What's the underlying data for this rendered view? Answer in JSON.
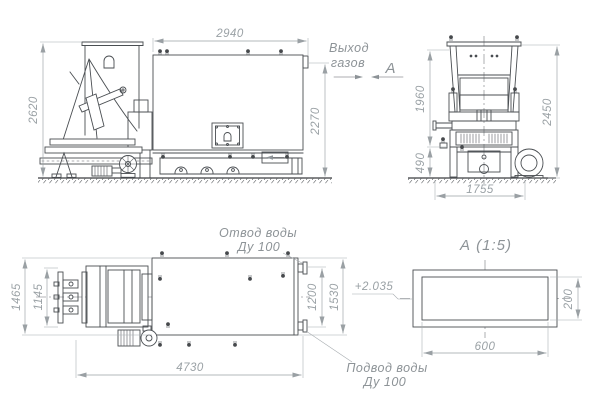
{
  "drawing": {
    "labels": {
      "gas_outlet_l1": "Выход",
      "gas_outlet_l2": "газов",
      "view_letter": "А",
      "water_outlet_l1": "Отвод воды",
      "water_outlet_l2": "Ду 100",
      "water_inlet_l1": "Подвод воды",
      "water_inlet_l2": "Ду 100",
      "section_title": "А  (1:5)",
      "elevation_mark": "+2.035"
    },
    "dimensions": {
      "side_view": {
        "height": "2620",
        "body_length": "2940",
        "flue_height": "2270"
      },
      "front_view": {
        "upper_height": "1960",
        "total_height": "2450",
        "base_height": "490",
        "width": "1755"
      },
      "plan_view": {
        "feeder_width": "1465",
        "feeder_inner_width": "1145",
        "total_length": "4730",
        "nozzle_spacing": "1200",
        "body_depth": "1530"
      },
      "section_a": {
        "width": "600",
        "height": "200"
      }
    },
    "colors": {
      "line": "#4a4e52",
      "dimension": "#9aa0a4",
      "background": "#ffffff"
    }
  }
}
